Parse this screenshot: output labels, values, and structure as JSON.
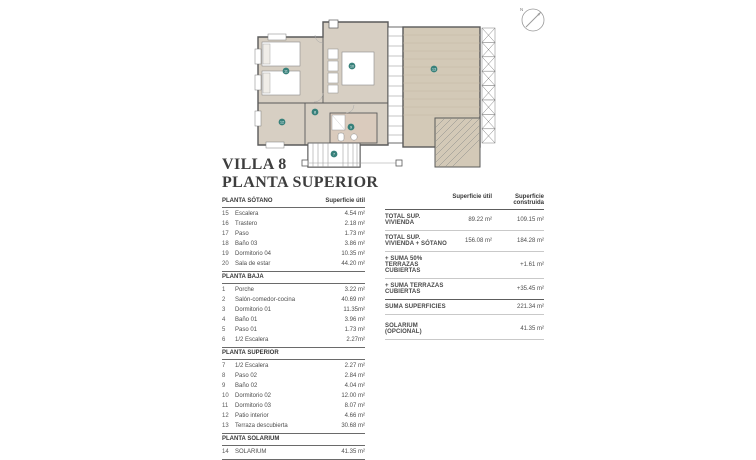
{
  "title": {
    "line1": "VILLA 8",
    "line2": "PLANTA SUPERIOR"
  },
  "plan": {
    "compass_label": "N",
    "markers": [
      "7",
      "8",
      "9",
      "10",
      "11",
      "12",
      "13"
    ]
  },
  "left_table": {
    "col_header": "Superficie útil",
    "sections": [
      {
        "header": "PLANTA SÓTANO",
        "rows": [
          {
            "num": "15",
            "label": "Escalera",
            "value": "4.54 m²"
          },
          {
            "num": "16",
            "label": "Trastero",
            "value": "2.18 m²"
          },
          {
            "num": "17",
            "label": "Paso",
            "value": "1.73 m²"
          },
          {
            "num": "18",
            "label": "Baño 03",
            "value": "3.86 m²"
          },
          {
            "num": "19",
            "label": "Dormitorio 04",
            "value": "10.35 m²"
          },
          {
            "num": "20",
            "label": "Sala de estar",
            "value": "44.20 m²"
          }
        ]
      },
      {
        "header": "PLANTA BAJA",
        "rows": [
          {
            "num": "1",
            "label": "Porche",
            "value": "3.22 m²"
          },
          {
            "num": "2",
            "label": "Salón-comedor-cocina",
            "value": "40.69 m²"
          },
          {
            "num": "3",
            "label": "Dormitorio 01",
            "value": "11.35m²"
          },
          {
            "num": "4",
            "label": "Baño 01",
            "value": "3.96 m²"
          },
          {
            "num": "5",
            "label": "Paso 01",
            "value": "1.73 m²"
          },
          {
            "num": "6",
            "label": "1/2 Escalera",
            "value": "2.27m²"
          }
        ]
      },
      {
        "header": "PLANTA SUPERIOR",
        "rows": [
          {
            "num": "7",
            "label": "1/2 Escalera",
            "value": "2.27 m²"
          },
          {
            "num": "8",
            "label": "Paso 02",
            "value": "2.84 m²"
          },
          {
            "num": "9",
            "label": "Baño 02",
            "value": "4.04 m²"
          },
          {
            "num": "10",
            "label": "Dormitorio 02",
            "value": "12.00 m²"
          },
          {
            "num": "11",
            "label": "Dormitorio 03",
            "value": "8.07 m²"
          },
          {
            "num": "12",
            "label": "Patio interior",
            "value": "4.66 m²"
          },
          {
            "num": "13",
            "label": "Terraza descubierta",
            "value": "30.68 m²"
          }
        ]
      },
      {
        "header": "PLANTA SOLARIUM",
        "rows": [
          {
            "num": "14",
            "label": "SOLARIUM",
            "value": "41.35 m²"
          }
        ]
      }
    ]
  },
  "summary_table": {
    "col_headers": {
      "util": "Superficie útil",
      "construida": "Superficie construida"
    },
    "rows": [
      {
        "label": "TOTAL SUP. VIVIENDA",
        "util": "89.22 m²",
        "construida": "109.15 m²"
      },
      {
        "label": "TOTAL SUP. VIVIENDA + SÓTANO",
        "util": "156.08 m²",
        "construida": "184.28 m²"
      },
      {
        "label": "+ SUMA 50% TERRAZAS CUBIERTAS",
        "util": "",
        "construida": "+1.61 m²"
      },
      {
        "label": "+ SUMA TERRAZAS CUBIERTAS",
        "util": "",
        "construida": "+35.45 m²"
      },
      {
        "label": "SUMA SUPERFICIES",
        "util": "",
        "construida": "221.34 m²"
      },
      {
        "label": "SOLARIUM (OPCIONAL)",
        "util": "",
        "construida": "41.35 m²"
      }
    ]
  },
  "colors": {
    "floor_tan": "#d7cfc3",
    "terrace_tan": "#d3c9b7",
    "bathroom_tan": "#dacbbd",
    "marker_teal": "#37807a",
    "wall": "#5a5a5a"
  }
}
